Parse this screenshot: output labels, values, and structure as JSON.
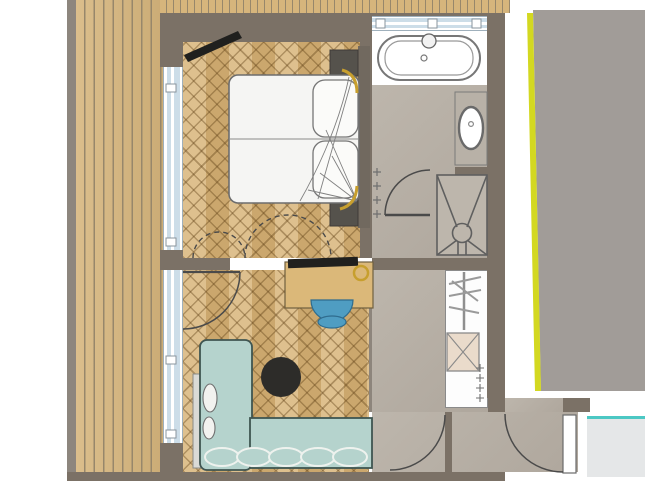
{
  "meta": {
    "kind": "architectural-floor-plan",
    "visible_text": ""
  },
  "colors": {
    "wall": "#7b7166",
    "terrace-edge": "#8d867e",
    "deck": "#d6b57c",
    "deck-gap": "#97876b",
    "parquet": "#d8b478",
    "parquet-line": "rgba(96,64,22,0.38)",
    "tile": "#b8b1a7",
    "glass": "#ccdde8",
    "sofa": "#b5d3cd",
    "sofa-line": "#3f5551",
    "chair": "#4f9dc2",
    "table-black": "#2d2c29",
    "tv-black": "#20201e",
    "nightstand": "#55524c",
    "headboard": "#71695f",
    "desk": "#dbb879",
    "box": "#eadbcb",
    "accent-gold": "#c79f2e",
    "accent-yellow": "#d3d821",
    "outside": "#a19c98",
    "entry-pad": "#e5e7e8",
    "threshold": "#4cc8c4",
    "line-dark": "#4a4a4a",
    "line-mid": "#787878"
  },
  "areas": [
    {
      "id": "terrace",
      "floor": "wood-decking"
    },
    {
      "id": "bedroom",
      "floor": "herringbone-parquet"
    },
    {
      "id": "bathroom",
      "floor": "stone-tile"
    },
    {
      "id": "living-area",
      "floor": "herringbone-parquet"
    },
    {
      "id": "corridor",
      "floor": "stone-tile"
    },
    {
      "id": "entry-vestibule",
      "floor": "stone-tile"
    }
  ],
  "furniture": [
    "double-bed",
    "pillows",
    "duvet",
    "nightstand-left",
    "nightstand-right",
    "headboard",
    "corner-tv",
    "sideboard-desk",
    "desk-tv",
    "decor-ring",
    "desk-chair",
    "chaise-lounge",
    "sofa",
    "seat-cushions",
    "throw-pillows",
    "coffee-table",
    "bathtub",
    "faucet",
    "washbasin",
    "vanity",
    "shower",
    "floor-drain",
    "towel-hooks",
    "wardrobe",
    "clothes-rail",
    "hangers",
    "storage-box",
    "coat-hooks"
  ],
  "openings": [
    "terrace-glazing-bedroom",
    "terrace-glazing-living",
    "bathroom-window",
    "bedroom-living-partition-swing",
    "bedroom-door",
    "bathroom-door",
    "corridor-door",
    "entry-door"
  ]
}
